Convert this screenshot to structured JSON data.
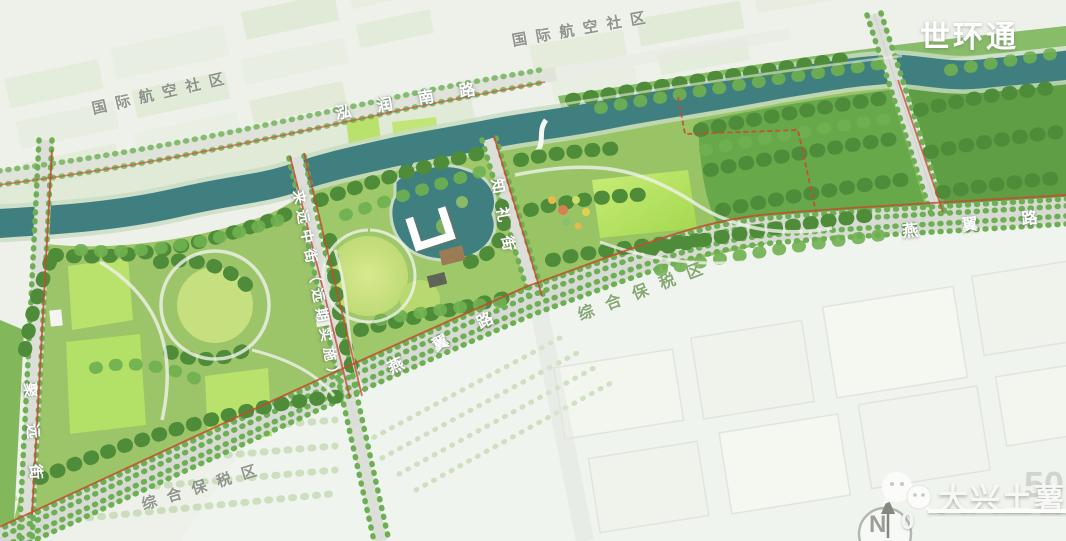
{
  "branding": {
    "logo_text": "世环通",
    "watermark_text": "大兴土薯"
  },
  "labels": {
    "aviation_left": {
      "text": "国际航空社区"
    },
    "aviation_top": {
      "text": "国际航空社区"
    },
    "hongrun_road": {
      "text": "泓润南路"
    },
    "zhili_street": {
      "text": "知礼街"
    },
    "laiyuan_street": {
      "text": "来远中街（远期实施）"
    },
    "juyuan_street": {
      "text": "聚远街"
    },
    "yanyi_road_west": {
      "text": "燕翼路"
    },
    "yanyi_road_east": {
      "text": "燕翼路"
    },
    "bonded_zone_mid": {
      "text": "综合保税区"
    },
    "bonded_zone_sw": {
      "text": "综合保税区"
    }
  },
  "compass": {
    "north_label": "N"
  },
  "scale_bar": {
    "start": "0",
    "end": "50"
  },
  "palette": {
    "river": "#3f7f80",
    "park_green": "#9cc468",
    "forest_green": "#5f9e44",
    "lawn_green": "#b7e169",
    "road_gray": "#d8dcd4",
    "boundary_red": "#c84a30",
    "city_wash": "#eef1ea"
  }
}
